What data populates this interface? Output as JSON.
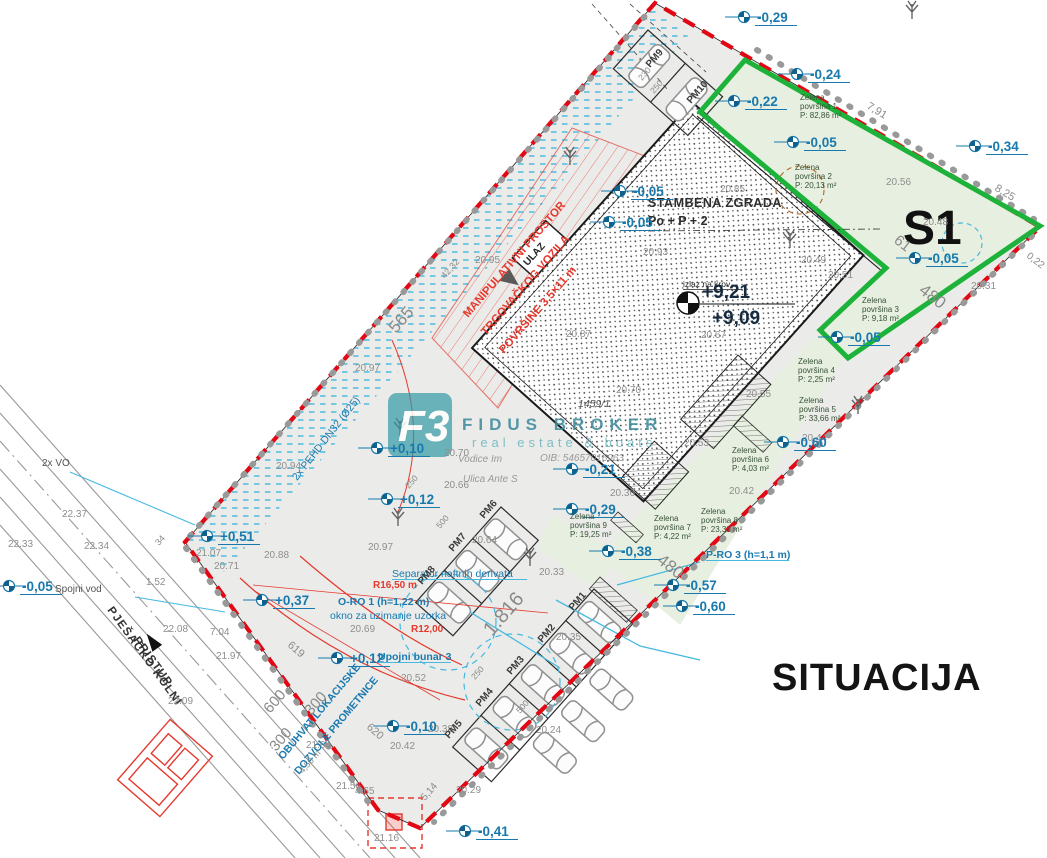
{
  "title": "SITUACIJA",
  "zone_label": "S1",
  "building": {
    "name": "STAMBENA ZGRADA",
    "floors": "Po + P + 2",
    "entrance": "ULAZ",
    "roof_exit": "izlaz na krov",
    "elev_top": "+9,21",
    "elev_floor": "+9,09"
  },
  "parcel_number": "1459/1",
  "watermark": {
    "logo": "F3",
    "brand": "FIDUS BROKER",
    "tagline": "real estate & boats",
    "address1": "Vodice Im",
    "address2": "Ulica Ante S",
    "oib": "OIB: 54657016963"
  },
  "red_zone": {
    "line1": "MANIPULATIVNI PROSTOR",
    "line2": "TRGOVAČKOG VOZILA",
    "line3": "POVRŠINE 3,5×11 m"
  },
  "roads": {
    "access_line1": "PJEŠAČKO KOLNI",
    "access_line2": "PRISTUP",
    "connector": "Spojni vod",
    "duct": "2x VO",
    "scope_line1": "OBUHVAT LOKACIJSKE",
    "scope_line2": "DOZVOLE PROMETNICE"
  },
  "green_areas": [
    {
      "l1": "Zelena",
      "l2": "površina 1",
      "area": "P: 82,86 m²",
      "x": 800,
      "y": 100
    },
    {
      "l1": "Zelena",
      "l2": "površina 2",
      "area": "P: 20,13 m²",
      "x": 795,
      "y": 170
    },
    {
      "l1": "Zelena",
      "l2": "površina 3",
      "area": "P: 9,18 m²",
      "x": 862,
      "y": 303
    },
    {
      "l1": "Zelena",
      "l2": "površina 4",
      "area": "P: 2,25 m²",
      "x": 798,
      "y": 364
    },
    {
      "l1": "Zelena",
      "l2": "površina 5",
      "area": "P: 33,66 m²",
      "x": 799,
      "y": 403
    },
    {
      "l1": "Zelena",
      "l2": "površina 6",
      "area": "P: 4,03 m²",
      "x": 732,
      "y": 453
    },
    {
      "l1": "Zelena",
      "l2": "površina 7",
      "area": "P: 4,22 m²",
      "x": 654,
      "y": 521
    },
    {
      "l1": "Zelena",
      "l2": "površina 8",
      "area": "P: 23,38 m²",
      "x": 701,
      "y": 514
    },
    {
      "l1": "Zelena",
      "l2": "površina 9",
      "area": "P: 19,25 m²",
      "x": 570,
      "y": 519
    }
  ],
  "parking_spots": [
    {
      "id": "PM1",
      "x": 573,
      "y": 611
    },
    {
      "id": "PM2",
      "x": 542,
      "y": 643
    },
    {
      "id": "PM3",
      "x": 511,
      "y": 675
    },
    {
      "id": "PM4",
      "x": 480,
      "y": 707
    },
    {
      "id": "PM5",
      "x": 449,
      "y": 739
    },
    {
      "id": "PM6",
      "x": 484,
      "y": 519
    },
    {
      "id": "PM7",
      "x": 453,
      "y": 552
    },
    {
      "id": "PM8",
      "x": 422,
      "y": 585
    },
    {
      "id": "PM9",
      "x": 650,
      "y": 68
    },
    {
      "id": "PM10",
      "x": 691,
      "y": 104
    }
  ],
  "elevation_marks": [
    {
      "t": "-0,29",
      "x": 757,
      "y": 22
    },
    {
      "t": "-0,24",
      "x": 810,
      "y": 79
    },
    {
      "t": "-0,22",
      "x": 747,
      "y": 106
    },
    {
      "t": "-0,05",
      "x": 806,
      "y": 147
    },
    {
      "t": "-0,34",
      "x": 988,
      "y": 151
    },
    {
      "t": "-0,05",
      "x": 928,
      "y": 263
    },
    {
      "t": "-0,05",
      "x": 850,
      "y": 342
    },
    {
      "t": "-0,05",
      "x": 633,
      "y": 196
    },
    {
      "t": "-0,05",
      "x": 622,
      "y": 227
    },
    {
      "t": "-0,21",
      "x": 585,
      "y": 474
    },
    {
      "t": "-0,29",
      "x": 585,
      "y": 514
    },
    {
      "t": "-0,38",
      "x": 621,
      "y": 556
    },
    {
      "t": "-0,57",
      "x": 686,
      "y": 590
    },
    {
      "t": "-0,60",
      "x": 695,
      "y": 611
    },
    {
      "t": "-0,60",
      "x": 796,
      "y": 447
    },
    {
      "t": "+0,10",
      "x": 390,
      "y": 453
    },
    {
      "t": "+0,12",
      "x": 400,
      "y": 504
    },
    {
      "t": "+0,51",
      "x": 220,
      "y": 541
    },
    {
      "t": "+0,37",
      "x": 275,
      "y": 605
    },
    {
      "t": "+0,12",
      "x": 350,
      "y": 663
    },
    {
      "t": "-0,10",
      "x": 406,
      "y": 731
    },
    {
      "t": "-0,41",
      "x": 478,
      "y": 836
    },
    {
      "t": "-0,05",
      "x": 22,
      "y": 591
    }
  ],
  "spot_heights": [
    {
      "t": "22.37",
      "x": 62,
      "y": 517
    },
    {
      "t": "22.33",
      "x": 8,
      "y": 547
    },
    {
      "t": "22.34",
      "x": 84,
      "y": 549
    },
    {
      "t": "22.08",
      "x": 163,
      "y": 632
    },
    {
      "t": "7.04",
      "x": 210,
      "y": 635
    },
    {
      "t": "21.97",
      "x": 216,
      "y": 659
    },
    {
      "t": "22.09",
      "x": 168,
      "y": 704
    },
    {
      "t": "1.52",
      "x": 146,
      "y": 585
    },
    {
      "t": "21.07",
      "x": 196,
      "y": 556
    },
    {
      "t": "20.71",
      "x": 214,
      "y": 569
    },
    {
      "t": "20.88",
      "x": 264,
      "y": 558
    },
    {
      "t": "20.94",
      "x": 276,
      "y": 469
    },
    {
      "t": "20.97",
      "x": 355,
      "y": 371
    },
    {
      "t": "20.95",
      "x": 475,
      "y": 263
    },
    {
      "t": "20.85",
      "x": 720,
      "y": 192
    },
    {
      "t": "20.93",
      "x": 643,
      "y": 255
    },
    {
      "t": "20.87",
      "x": 566,
      "y": 337
    },
    {
      "t": "20.67",
      "x": 701,
      "y": 338
    },
    {
      "t": "20.70",
      "x": 616,
      "y": 393
    },
    {
      "t": "20.55",
      "x": 746,
      "y": 397
    },
    {
      "t": "20.56",
      "x": 886,
      "y": 185
    },
    {
      "t": "20.48",
      "x": 923,
      "y": 225
    },
    {
      "t": "20.51",
      "x": 828,
      "y": 278
    },
    {
      "t": "20.49",
      "x": 801,
      "y": 263
    },
    {
      "t": "20.31",
      "x": 971,
      "y": 289
    },
    {
      "t": "20.53",
      "x": 684,
      "y": 446
    },
    {
      "t": "20.44",
      "x": 802,
      "y": 441
    },
    {
      "t": "20.42",
      "x": 729,
      "y": 494
    },
    {
      "t": "20.36",
      "x": 610,
      "y": 496
    },
    {
      "t": "20.33",
      "x": 539,
      "y": 575
    },
    {
      "t": "20.66",
      "x": 444,
      "y": 488
    },
    {
      "t": "20.64",
      "x": 472,
      "y": 543
    },
    {
      "t": "20.97",
      "x": 368,
      "y": 550
    },
    {
      "t": "20.70",
      "x": 444,
      "y": 456
    },
    {
      "t": "20.69",
      "x": 350,
      "y": 632
    },
    {
      "t": "20.52",
      "x": 401,
      "y": 681
    },
    {
      "t": "20.42",
      "x": 390,
      "y": 749
    },
    {
      "t": "20.29",
      "x": 456,
      "y": 793
    },
    {
      "t": "20.24",
      "x": 536,
      "y": 733
    },
    {
      "t": "20.38",
      "x": 428,
      "y": 732
    },
    {
      "t": "20.35",
      "x": 556,
      "y": 640
    },
    {
      "t": "21.64",
      "x": 306,
      "y": 748
    },
    {
      "t": "21.56",
      "x": 336,
      "y": 789
    },
    {
      "t": "21.16",
      "x": 374,
      "y": 841
    },
    {
      "t": "4.65",
      "x": 355,
      "y": 794
    }
  ],
  "dimensions": [
    {
      "t": "565",
      "x": 396,
      "y": 334,
      "r": -49,
      "s": 17
    },
    {
      "t": "42,32",
      "x": 445,
      "y": 279,
      "r": -49,
      "s": 9
    },
    {
      "t": "34",
      "x": 159,
      "y": 546,
      "r": -49,
      "s": 9
    },
    {
      "t": "1.816",
      "x": 492,
      "y": 637,
      "r": -49,
      "s": 20
    },
    {
      "t": "480",
      "x": 656,
      "y": 562,
      "r": 38,
      "s": 17
    },
    {
      "t": "480",
      "x": 918,
      "y": 292,
      "r": 38,
      "s": 17
    },
    {
      "t": "61",
      "x": 893,
      "y": 242,
      "r": 38,
      "s": 15
    },
    {
      "t": "7,91",
      "x": 866,
      "y": 108,
      "r": 31,
      "s": 11
    },
    {
      "t": "8,25",
      "x": 994,
      "y": 190,
      "r": 31,
      "s": 11
    },
    {
      "t": "0,22",
      "x": 1026,
      "y": 257,
      "r": 38,
      "s": 10
    },
    {
      "t": "619",
      "x": 287,
      "y": 646,
      "r": 41,
      "s": 11
    },
    {
      "t": "620",
      "x": 366,
      "y": 728,
      "r": 41,
      "s": 11
    },
    {
      "t": "600",
      "x": 270,
      "y": 714,
      "r": -49,
      "s": 15
    },
    {
      "t": "300",
      "x": 311,
      "y": 716,
      "r": -49,
      "s": 15
    },
    {
      "t": "300",
      "x": 276,
      "y": 752,
      "r": -49,
      "s": 15
    },
    {
      "t": "250",
      "x": 409,
      "y": 489,
      "r": -49,
      "s": 8.5
    },
    {
      "t": "500",
      "x": 440,
      "y": 529,
      "r": -49,
      "s": 8.5
    },
    {
      "t": "250",
      "x": 475,
      "y": 680,
      "r": -49,
      "s": 8.5
    },
    {
      "t": "500",
      "x": 520,
      "y": 714,
      "r": -49,
      "s": 8.5
    },
    {
      "t": "230",
      "x": 642,
      "y": 81,
      "r": -49,
      "s": 8.5
    },
    {
      "t": "250",
      "x": 654,
      "y": 94,
      "r": -49,
      "s": 8.5
    },
    {
      "t": "5,14",
      "x": 425,
      "y": 801,
      "r": -49,
      "s": 10
    },
    {
      "t": "4,50 m",
      "x": 303,
      "y": 774,
      "r": -49,
      "s": 9,
      "c": "#e5392d"
    }
  ],
  "utility_labels": [
    {
      "t": "Separator naftnih derivata",
      "x": 392,
      "y": 577,
      "u": 1
    },
    {
      "t": "O-RO 1 (h=1,22 m)",
      "x": 338,
      "y": 605,
      "b": 1
    },
    {
      "t": "okno za uzimanje uzorka",
      "x": 330,
      "y": 619
    },
    {
      "t": "Upojni bunar 3",
      "x": 378,
      "y": 660,
      "u": 1,
      "b": 1
    },
    {
      "t": "P-RO 3 (h=1,1 m)",
      "x": 706,
      "y": 558,
      "u": 1,
      "b": 1
    },
    {
      "t": "2x PEHD DN32 (Ø25)",
      "x": 297,
      "y": 481,
      "r": -52
    }
  ],
  "red_labels": [
    {
      "t": "R16,50 m",
      "x": 373,
      "y": 588
    },
    {
      "t": "R12,00",
      "x": 411,
      "y": 632
    }
  ]
}
